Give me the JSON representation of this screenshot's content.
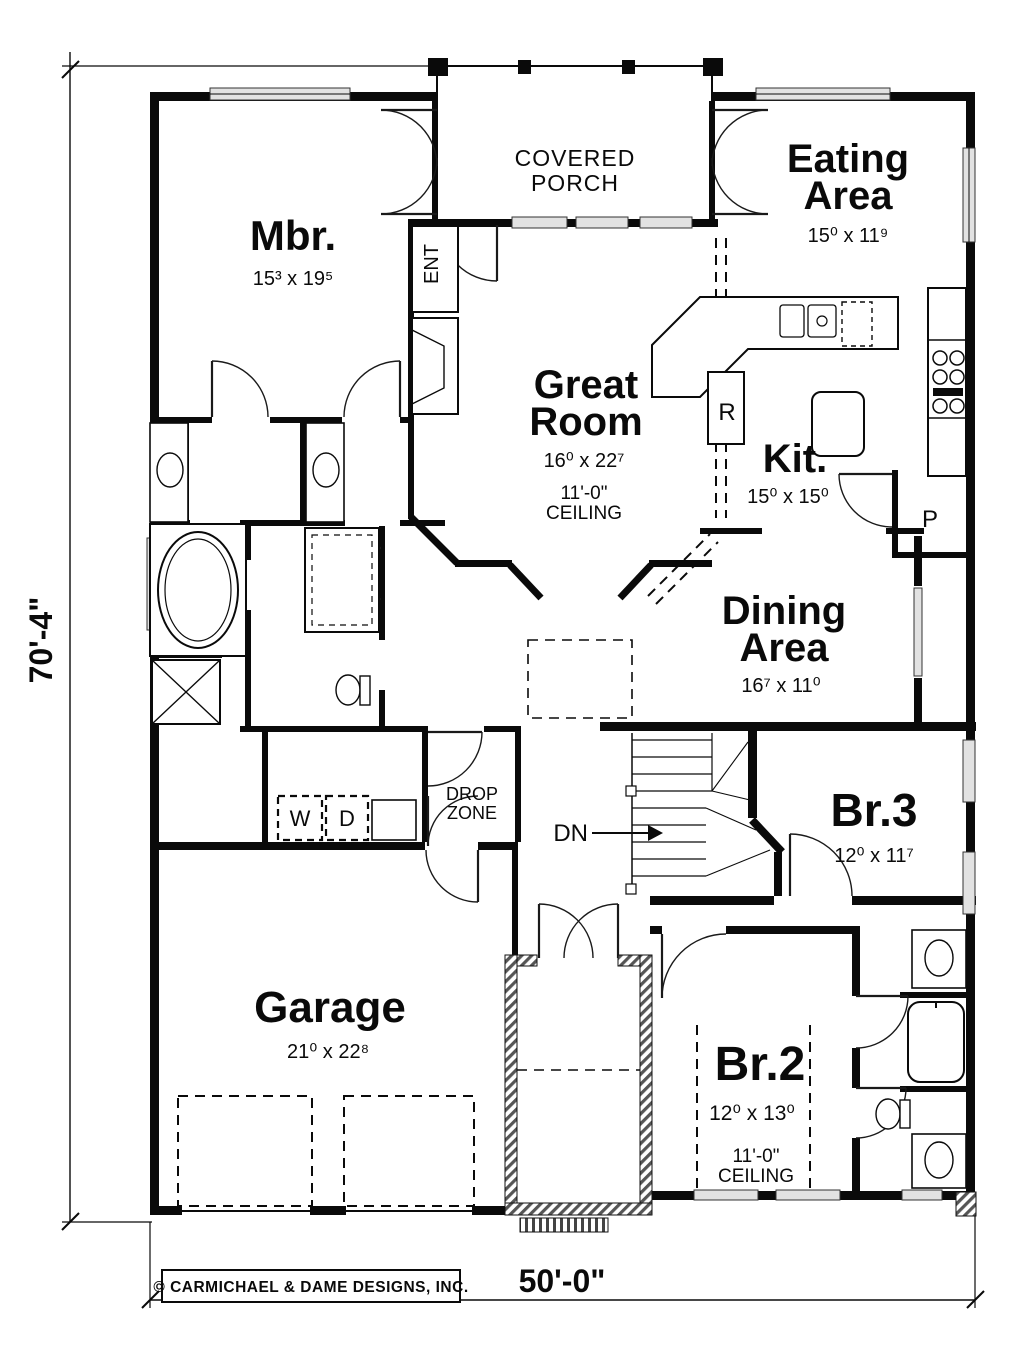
{
  "plan": {
    "rooms": {
      "covered_porch": {
        "l1": "COVERED",
        "l2": "PORCH"
      },
      "eating": {
        "l1": "Eating",
        "l2": "Area",
        "size": "15⁰ x 11⁹"
      },
      "mbr": {
        "name": "Mbr.",
        "size": "15³ x 19⁵"
      },
      "great": {
        "l1": "Great",
        "l2": "Room",
        "size": "16⁰ x 22⁷",
        "ceil1": "11'-0\"",
        "ceil2": "CEILING"
      },
      "kit": {
        "name": "Kit.",
        "size": "15⁰ x 15⁰"
      },
      "dining": {
        "l1": "Dining",
        "l2": "Area",
        "size": "16⁷ x 11⁰"
      },
      "br3": {
        "name": "Br.3",
        "size": "12⁰ x 11⁷"
      },
      "garage": {
        "name": "Garage",
        "size": "21⁰ x 22⁸"
      },
      "br2": {
        "name": "Br.2",
        "size": "12⁰ x 13⁰",
        "ceil1": "11'-0\"",
        "ceil2": "CEILING"
      },
      "drop_zone": {
        "l1": "DROP",
        "l2": "ZONE"
      }
    },
    "labels": {
      "ent": "ENT",
      "range": "R",
      "pantry": "P",
      "washer": "W",
      "dryer": "D",
      "down": "DN"
    },
    "dimensions": {
      "width": "50'-0\"",
      "height": "70'-4\""
    },
    "copyright": "© CARMICHAEL & DAME DESIGNS, INC."
  }
}
